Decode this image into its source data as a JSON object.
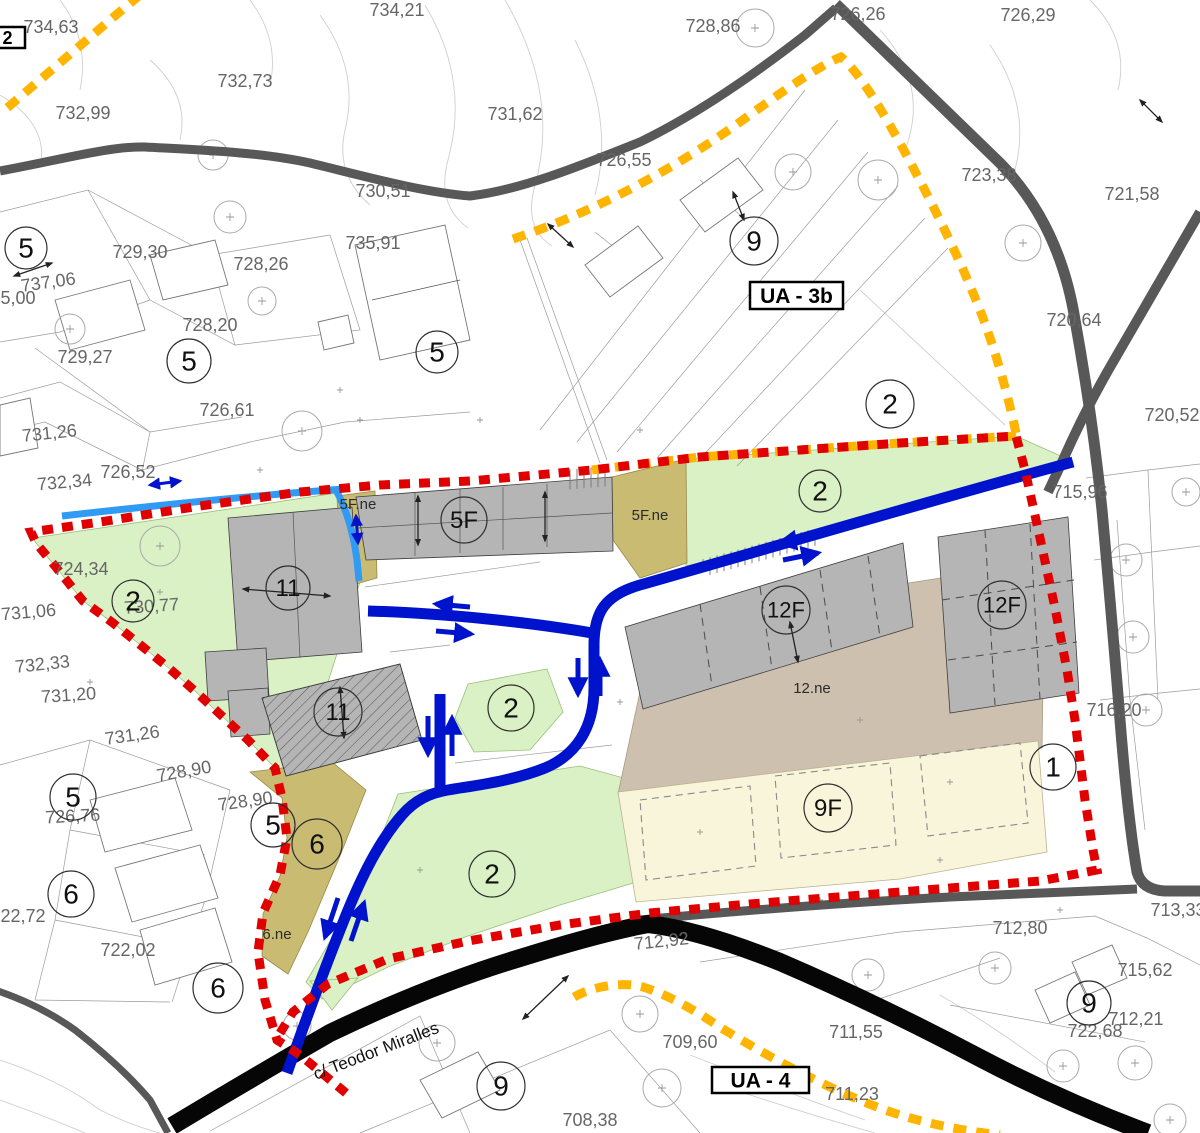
{
  "colors": {
    "boundary_red": "#e10000",
    "boundary_yellow": "#ffb400",
    "road_blue": "#0013cc",
    "road_cyan": "#2f9bf5",
    "road_gray": "#585858",
    "road_black": "#060606",
    "zone_green": "#d9f1c4",
    "zone_olive": "#c9bb72",
    "zone_cream": "#f8f5da",
    "zone_tan": "#cec0ae",
    "building_gray": "#b5b5b5",
    "label_gray": "#666666"
  },
  "boxed_labels": [
    {
      "text": "2",
      "x": -10,
      "y": 27,
      "w": 35,
      "h": 21,
      "fs": 18
    },
    {
      "text": "UA - 3b",
      "x": 750,
      "y": 282,
      "w": 93,
      "h": 27,
      "fs": 21
    },
    {
      "text": "UA - 4",
      "x": 712,
      "y": 1067,
      "w": 97,
      "h": 26,
      "fs": 21
    }
  ],
  "zone_circles": [
    {
      "label": "5",
      "x": 26,
      "y": 248,
      "r": 21
    },
    {
      "label": "5",
      "x": 189,
      "y": 361,
      "r": 22
    },
    {
      "label": "5",
      "x": 437,
      "y": 352,
      "r": 21
    },
    {
      "label": "9",
      "x": 754,
      "y": 241,
      "r": 24
    },
    {
      "label": "2",
      "x": 890,
      "y": 404,
      "r": 24
    },
    {
      "label": "2",
      "x": 820,
      "y": 491,
      "r": 21
    },
    {
      "label": "5F",
      "x": 464,
      "y": 520,
      "r": 23
    },
    {
      "label": "11",
      "x": 288,
      "y": 588,
      "r": 22
    },
    {
      "label": "2",
      "x": 133,
      "y": 601,
      "r": 21
    },
    {
      "label": "11",
      "x": 338,
      "y": 712,
      "r": 24
    },
    {
      "label": "2",
      "x": 511,
      "y": 708,
      "r": 23
    },
    {
      "label": "12F",
      "x": 786,
      "y": 610,
      "r": 24
    },
    {
      "label": "12F",
      "x": 1002,
      "y": 605,
      "r": 24
    },
    {
      "label": "1",
      "x": 1053,
      "y": 767,
      "r": 23
    },
    {
      "label": "9F",
      "x": 828,
      "y": 808,
      "r": 24
    },
    {
      "label": "2",
      "x": 492,
      "y": 874,
      "r": 23
    },
    {
      "label": "6",
      "x": 317,
      "y": 844,
      "r": 25
    },
    {
      "label": "5",
      "x": 273,
      "y": 825,
      "r": 22
    },
    {
      "label": "5",
      "x": 73,
      "y": 797,
      "r": 23
    },
    {
      "label": "6",
      "x": 71,
      "y": 894,
      "r": 23
    },
    {
      "label": "6",
      "x": 218,
      "y": 988,
      "r": 25
    },
    {
      "label": "9",
      "x": 1089,
      "y": 1003,
      "r": 22
    },
    {
      "label": "9",
      "x": 501,
      "y": 1086,
      "r": 24
    }
  ],
  "elevation_labels": [
    {
      "text": "734,21",
      "x": 397,
      "y": 16
    },
    {
      "text": "734,63",
      "x": 51,
      "y": 33
    },
    {
      "text": "732,99",
      "x": 83,
      "y": 119
    },
    {
      "text": "732,73",
      "x": 245,
      "y": 87
    },
    {
      "text": "731,62",
      "x": 515,
      "y": 120
    },
    {
      "text": "728,86",
      "x": 713,
      "y": 32
    },
    {
      "text": "726,26",
      "x": 858,
      "y": 20
    },
    {
      "text": "726,29",
      "x": 1028,
      "y": 21
    },
    {
      "text": "723,38",
      "x": 989,
      "y": 181
    },
    {
      "text": "721,58",
      "x": 1132,
      "y": 200
    },
    {
      "text": "726,55",
      "x": 624,
      "y": 166
    },
    {
      "text": "730,51",
      "x": 383,
      "y": 197
    },
    {
      "text": "735,91",
      "x": 373,
      "y": 249
    },
    {
      "text": "729,30",
      "x": 140,
      "y": 258
    },
    {
      "text": "728,26",
      "x": 261,
      "y": 270
    },
    {
      "text": "737,06",
      "x": 49,
      "y": 288,
      "rot": -8
    },
    {
      "text": "735,00",
      "x": 8,
      "y": 304
    },
    {
      "text": "728,20",
      "x": 210,
      "y": 331
    },
    {
      "text": "729,27",
      "x": 85,
      "y": 363
    },
    {
      "text": "726,61",
      "x": 227,
      "y": 416
    },
    {
      "text": "731,26",
      "x": 50,
      "y": 439,
      "rot": -6
    },
    {
      "text": "726,52",
      "x": 128,
      "y": 478
    },
    {
      "text": "732,34",
      "x": 65,
      "y": 488,
      "rot": -5
    },
    {
      "text": "720,64",
      "x": 1074,
      "y": 326
    },
    {
      "text": "720,52",
      "x": 1172,
      "y": 421
    },
    {
      "text": "715,96",
      "x": 1080,
      "y": 498
    },
    {
      "text": "724,34",
      "x": 81,
      "y": 575
    },
    {
      "text": "730,77",
      "x": 152,
      "y": 612,
      "rot": -4
    },
    {
      "text": "731,06",
      "x": 29,
      "y": 618,
      "rot": -5
    },
    {
      "text": "732,33",
      "x": 43,
      "y": 670,
      "rot": -6
    },
    {
      "text": "731,20",
      "x": 69,
      "y": 701,
      "rot": -4
    },
    {
      "text": "731,26",
      "x": 133,
      "y": 741,
      "rot": -8
    },
    {
      "text": "728,90",
      "x": 185,
      "y": 777,
      "rot": -10
    },
    {
      "text": "728,90",
      "x": 246,
      "y": 807,
      "rot": -8
    },
    {
      "text": "726,76",
      "x": 73,
      "y": 822,
      "rot": -3
    },
    {
      "text": "716,20",
      "x": 1114,
      "y": 716
    },
    {
      "text": "722,72",
      "x": 18,
      "y": 922
    },
    {
      "text": "722,02",
      "x": 128,
      "y": 956
    },
    {
      "text": "712,92",
      "x": 662,
      "y": 947,
      "rot": -6,
      "color": "#ffffff"
    },
    {
      "text": "713,33",
      "x": 1178,
      "y": 916
    },
    {
      "text": "712,80",
      "x": 1020,
      "y": 934
    },
    {
      "text": "715,62",
      "x": 1145,
      "y": 976,
      "size": 15
    },
    {
      "text": "722,68",
      "x": 1095,
      "y": 1037,
      "size": 15
    },
    {
      "text": "712,21",
      "x": 1136,
      "y": 1025
    },
    {
      "text": "711,55",
      "x": 856,
      "y": 1038
    },
    {
      "text": "711,23",
      "x": 852,
      "y": 1100
    },
    {
      "text": "709,60",
      "x": 690,
      "y": 1048
    },
    {
      "text": "708,38",
      "x": 590,
      "y": 1126
    }
  ],
  "area_labels": [
    {
      "text": "5F.ne",
      "x": 358,
      "y": 509
    },
    {
      "text": "5F.ne",
      "x": 650,
      "y": 520
    },
    {
      "text": "12.ne",
      "x": 812,
      "y": 693,
      "size": 13
    },
    {
      "text": "6.ne",
      "x": 277,
      "y": 939
    }
  ],
  "street_label": {
    "text": "c/ Teodor Miralles",
    "x": 378,
    "y": 1056,
    "rot": -21
  }
}
